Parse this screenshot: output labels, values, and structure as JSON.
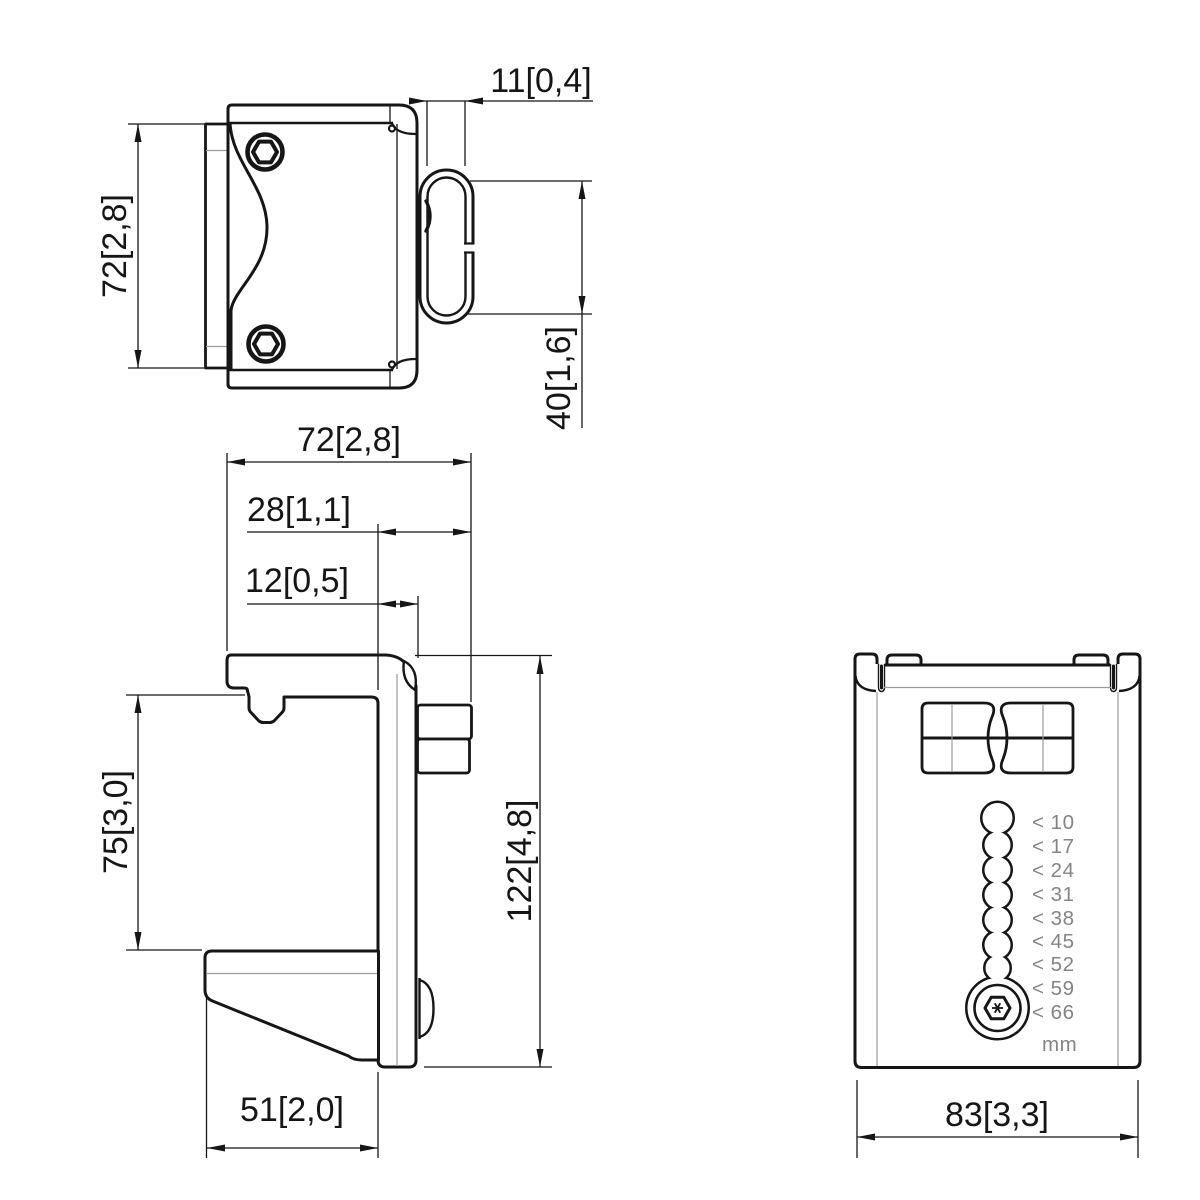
{
  "page": {
    "background": "#ffffff",
    "ink_color": "#161616",
    "thin_edge_color": "#9b9b9b",
    "muted_text_color": "#848484"
  },
  "views": {
    "front": {
      "dims": {
        "loop_offset": "11[0,4]",
        "height": "72[2,8]",
        "loop_height": "40[1,6]"
      }
    },
    "side": {
      "dims": {
        "depth": "72[2,8]",
        "hook_inset": "28[1,1]",
        "plate_thickness": "12[0,5]",
        "opening_height": "75[3,0]",
        "total_height": "122[4,8]",
        "foot_depth": "51[2,0]"
      }
    },
    "rear": {
      "dims": {
        "width": "83[3,3]"
      },
      "thickness_scale": {
        "labels": [
          "< 10",
          "< 17",
          "< 24",
          "< 31",
          "< 38",
          "< 45",
          "< 52",
          "< 59",
          "< 66"
        ],
        "unit": "mm"
      }
    }
  }
}
